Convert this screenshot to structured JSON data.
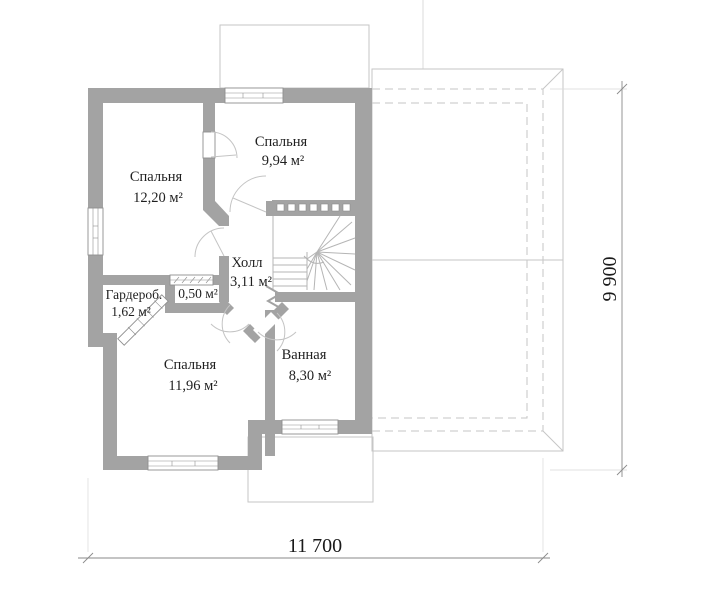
{
  "plan": {
    "rooms": [
      {
        "name": "Спальня",
        "area": "12,20 м²"
      },
      {
        "name": "Спальня",
        "area": "9,94 м²"
      },
      {
        "name": "Холл",
        "area": "3,11 м²"
      },
      {
        "name": "Гардероб.",
        "area": "1,62 м²"
      },
      {
        "name": "",
        "area": "0,50 м²"
      },
      {
        "name": "Спальня",
        "area": "11,96 м²"
      },
      {
        "name": "Ванная",
        "area": "8,30 м²"
      }
    ],
    "dimensions": {
      "width": "11 700",
      "height": "9 900"
    },
    "colors": {
      "wall": "#a3a3a3",
      "outline": "#c6c6c6",
      "dimension": "#8a8a8a",
      "text": "#1f1f1f",
      "background": "#ffffff"
    }
  }
}
